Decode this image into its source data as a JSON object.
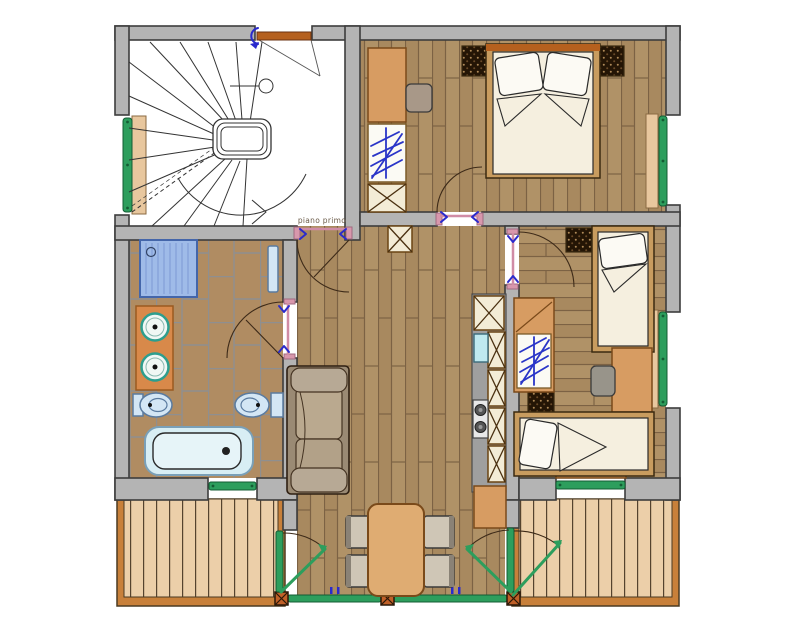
{
  "floor_label": "piano primo",
  "plan": {
    "type": "apartment-floor-plan",
    "rooms": [
      {
        "name": "staircase-hall",
        "features": [
          "spiral-staircase",
          "entry-door",
          "window-left"
        ]
      },
      {
        "name": "double-bedroom",
        "features": [
          "double-bed",
          "wardrobe",
          "dresser",
          "chair",
          "two-radiators",
          "window-right"
        ]
      },
      {
        "name": "twin-bedroom",
        "features": [
          "single-bed-vertical",
          "single-bed-horizontal",
          "wardrobe",
          "desk",
          "chair",
          "two-radiators",
          "window-right",
          "window-bottom"
        ]
      },
      {
        "name": "bathroom",
        "features": [
          "shower",
          "double-washbasin-counter",
          "bidet",
          "toilet",
          "bathtub",
          "towel-rail",
          "window-bottom"
        ]
      },
      {
        "name": "living-dining-room",
        "features": [
          "sofa",
          "dining-table",
          "four-chairs",
          "glazed-doors-to-balconies"
        ]
      },
      {
        "name": "kitchenette",
        "features": [
          "sink",
          "two-burner-stove",
          "cabinets",
          "base-cabinet"
        ]
      },
      {
        "name": "balcony-left",
        "features": [
          "wood-decking"
        ]
      },
      {
        "name": "balcony-right",
        "features": [
          "wood-decking"
        ]
      }
    ]
  },
  "colors": {
    "wall": "#b4b4b4",
    "wall_outline": "#3d3d3d",
    "wood_floor": "#a8895f",
    "bath_tile": "#b08c62",
    "deck": "#eccfa9",
    "deck_border": "#c8803a",
    "window_green": "#2d9e5d",
    "door_frame_pink": "#d897ac",
    "swing_arrow_blue": "#2a2acc",
    "entry_door_orange": "#b5601e",
    "furniture_orange": "#d79c62",
    "cabinet_face": "#f3ecd6",
    "mattress_cream": "#f5efdf",
    "sofa_cushion": "#b8aca2",
    "fixture_blue": "#d8eef4",
    "shower_blue": "#9fbbe8",
    "counter_orange": "#d8894a"
  }
}
